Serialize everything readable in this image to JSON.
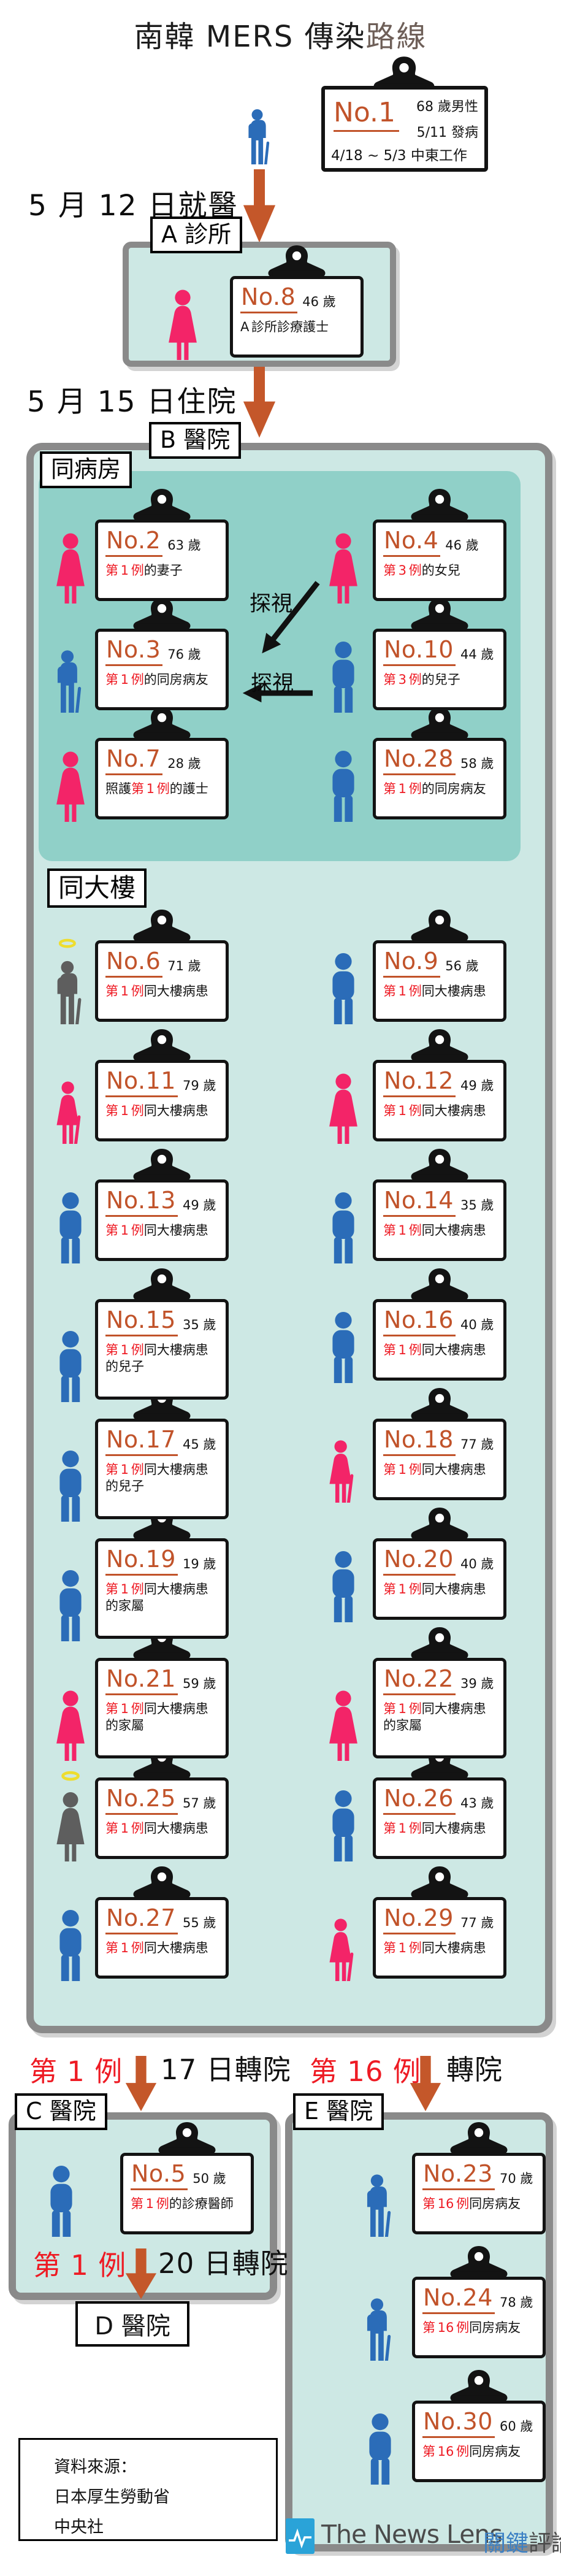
{
  "title": {
    "prefix": "南韓 MERS 傳染",
    "suffix": "路線"
  },
  "colors": {
    "accent_orange": "#c1532a",
    "arrow_orange": "#c4572a",
    "case_red": "#ee1b24",
    "male_blue": "#2b6cb8",
    "female_pink": "#f32468",
    "deceased_gray": "#5e5e5e",
    "halo_yellow": "#eedd2e",
    "hospital_fill": "#cde8e4",
    "ward_fill": "#90d0c8",
    "border_gray": "#8a8a8a",
    "logo_blue": "#2aa3d8"
  },
  "index_patient": {
    "no": "No.1",
    "info1": "68 歲男性",
    "info2": "5/11 發病",
    "info3": "4/18 ~ 5/3 中東工作",
    "icon": "elderly-man-blue"
  },
  "steps": [
    {
      "label": "5 月 12 日就醫"
    },
    {
      "label": "5 月 15 日住院"
    }
  ],
  "clinic_a": {
    "label": "A 診所",
    "patients": [
      {
        "no": "No.8",
        "age": "46 歲",
        "desc": [
          {
            "t": "A 診所診療護士",
            "r": false
          }
        ],
        "icon": "woman-pink"
      }
    ]
  },
  "hospital_b": {
    "label": "B 醫院",
    "visit_label": "探視",
    "ward": {
      "label": "同病房",
      "patients": [
        {
          "no": "No.2",
          "age": "63 歲",
          "desc": [
            {
              "t": "第 1 例",
              "r": true
            },
            {
              "t": "的妻子",
              "r": false
            }
          ],
          "icon": "woman-pink"
        },
        {
          "no": "No.4",
          "age": "46 歲",
          "desc": [
            {
              "t": "第 3 例",
              "r": true
            },
            {
              "t": "的女兒",
              "r": false
            }
          ],
          "icon": "woman-pink"
        },
        {
          "no": "No.3",
          "age": "76 歲",
          "desc": [
            {
              "t": "第 1 例",
              "r": true
            },
            {
              "t": "的同房病友",
              "r": false
            }
          ],
          "icon": "elderly-man-blue"
        },
        {
          "no": "No.10",
          "age": "44 歲",
          "desc": [
            {
              "t": "第 3 例",
              "r": true
            },
            {
              "t": "的兒子",
              "r": false
            }
          ],
          "icon": "man-blue"
        },
        {
          "no": "No.7",
          "age": "28 歲",
          "desc": [
            {
              "t": "照護",
              "r": false
            },
            {
              "t": "第 1 例",
              "r": true
            },
            {
              "t": "的護士",
              "r": false
            }
          ],
          "icon": "woman-pink"
        },
        {
          "no": "No.28",
          "age": "58 歲",
          "desc": [
            {
              "t": "第 1 例",
              "r": true
            },
            {
              "t": "的同房病友",
              "r": false
            }
          ],
          "icon": "man-blue"
        }
      ]
    },
    "building": {
      "label": "同大樓",
      "patients": [
        {
          "no": "No.6",
          "age": "71 歲",
          "desc": [
            {
              "t": "第 1 例",
              "r": true
            },
            {
              "t": "同大樓病患",
              "r": false
            }
          ],
          "icon": "elderly-man-gray-halo"
        },
        {
          "no": "No.9",
          "age": "56 歲",
          "desc": [
            {
              "t": "第 1 例",
              "r": true
            },
            {
              "t": "同大樓病患",
              "r": false
            }
          ],
          "icon": "man-blue"
        },
        {
          "no": "No.11",
          "age": "79 歲",
          "desc": [
            {
              "t": "第 1 例",
              "r": true
            },
            {
              "t": "同大樓病患",
              "r": false
            }
          ],
          "icon": "elderly-woman-pink"
        },
        {
          "no": "No.12",
          "age": "49 歲",
          "desc": [
            {
              "t": "第 1 例",
              "r": true
            },
            {
              "t": "同大樓病患",
              "r": false
            }
          ],
          "icon": "woman-pink"
        },
        {
          "no": "No.13",
          "age": "49 歲",
          "desc": [
            {
              "t": "第 1 例",
              "r": true
            },
            {
              "t": "同大樓病患",
              "r": false
            }
          ],
          "icon": "man-blue"
        },
        {
          "no": "No.14",
          "age": "35 歲",
          "desc": [
            {
              "t": "第 1 例",
              "r": true
            },
            {
              "t": "同大樓病患",
              "r": false
            }
          ],
          "icon": "man-blue"
        },
        {
          "no": "No.15",
          "age": "35 歲",
          "desc": [
            {
              "t": "第 1 例",
              "r": true
            },
            {
              "t": "同大樓病患",
              "r": false
            },
            {
              "t": "的兒子",
              "r": false
            }
          ],
          "icon": "man-blue"
        },
        {
          "no": "No.16",
          "age": "40 歲",
          "desc": [
            {
              "t": "第 1 例",
              "r": true
            },
            {
              "t": "同大樓病患",
              "r": false
            }
          ],
          "icon": "man-blue"
        },
        {
          "no": "No.17",
          "age": "45 歲",
          "desc": [
            {
              "t": "第 1 例",
              "r": true
            },
            {
              "t": "同大樓病患",
              "r": false
            },
            {
              "t": "的兒子",
              "r": false
            }
          ],
          "icon": "man-blue"
        },
        {
          "no": "No.18",
          "age": "77 歲",
          "desc": [
            {
              "t": "第 1 例",
              "r": true
            },
            {
              "t": "同大樓病患",
              "r": false
            }
          ],
          "icon": "elderly-woman-pink"
        },
        {
          "no": "No.19",
          "age": "19 歲",
          "desc": [
            {
              "t": "第 1 例",
              "r": true
            },
            {
              "t": "同大樓病患",
              "r": false
            },
            {
              "t": "的家屬",
              "r": false
            }
          ],
          "icon": "man-blue"
        },
        {
          "no": "No.20",
          "age": "40 歲",
          "desc": [
            {
              "t": "第 1 例",
              "r": true
            },
            {
              "t": "同大樓病患",
              "r": false
            }
          ],
          "icon": "man-blue"
        },
        {
          "no": "No.21",
          "age": "59 歲",
          "desc": [
            {
              "t": "第 1 例",
              "r": true
            },
            {
              "t": "同大樓病患",
              "r": false
            },
            {
              "t": "的家屬",
              "r": false
            }
          ],
          "icon": "woman-pink"
        },
        {
          "no": "No.22",
          "age": "39 歲",
          "desc": [
            {
              "t": "第 1 例",
              "r": true
            },
            {
              "t": "同大樓病患",
              "r": false
            },
            {
              "t": "的家屬",
              "r": false
            }
          ],
          "icon": "woman-pink"
        },
        {
          "no": "No.25",
          "age": "57 歲",
          "desc": [
            {
              "t": "第 1 例",
              "r": true
            },
            {
              "t": "同大樓病患",
              "r": false
            }
          ],
          "icon": "woman-gray-halo"
        },
        {
          "no": "No.26",
          "age": "43 歲",
          "desc": [
            {
              "t": "第 1 例",
              "r": true
            },
            {
              "t": "同大樓病患",
              "r": false
            }
          ],
          "icon": "man-blue"
        },
        {
          "no": "No.27",
          "age": "55 歲",
          "desc": [
            {
              "t": "第 1 例",
              "r": true
            },
            {
              "t": "同大樓病患",
              "r": false
            }
          ],
          "icon": "man-blue"
        },
        {
          "no": "No.29",
          "age": "77 歲",
          "desc": [
            {
              "t": "第 1 例",
              "r": true
            },
            {
              "t": "同大樓病患",
              "r": false
            }
          ],
          "icon": "elderly-woman-pink"
        }
      ]
    }
  },
  "transfers": [
    {
      "case_label": "第 1 例",
      "action": "17 日轉院"
    },
    {
      "case_label": "第 16 例",
      "action": "轉院"
    },
    {
      "case_label": "第 1 例",
      "action": "20 日轉院"
    }
  ],
  "hospital_c": {
    "label": "C 醫院",
    "patients": [
      {
        "no": "No.5",
        "age": "50 歲",
        "desc": [
          {
            "t": "第 1 例",
            "r": true
          },
          {
            "t": "的診療醫師",
            "r": false
          }
        ],
        "icon": "man-blue"
      }
    ]
  },
  "hospital_d": {
    "label": "D 醫院"
  },
  "hospital_e": {
    "label": "E 醫院",
    "patients": [
      {
        "no": "No.23",
        "age": "70 歲",
        "desc": [
          {
            "t": "第 16 例",
            "r": true
          },
          {
            "t": "同房病友",
            "r": false
          }
        ],
        "icon": "elderly-man-blue"
      },
      {
        "no": "No.24",
        "age": "78 歲",
        "desc": [
          {
            "t": "第 16 例",
            "r": true
          },
          {
            "t": "同房病友",
            "r": false
          }
        ],
        "icon": "elderly-man-blue"
      },
      {
        "no": "No.30",
        "age": "60 歲",
        "desc": [
          {
            "t": "第 16 例",
            "r": true
          },
          {
            "t": "同房病友",
            "r": false
          }
        ],
        "icon": "man-blue"
      }
    ]
  },
  "source": {
    "lines": [
      "資料來源：",
      "日本厚生勞動省",
      "中央社"
    ]
  },
  "logo": {
    "en": "The News Lens",
    "zh_blue": "關鍵",
    "zh_gray": "評論"
  }
}
